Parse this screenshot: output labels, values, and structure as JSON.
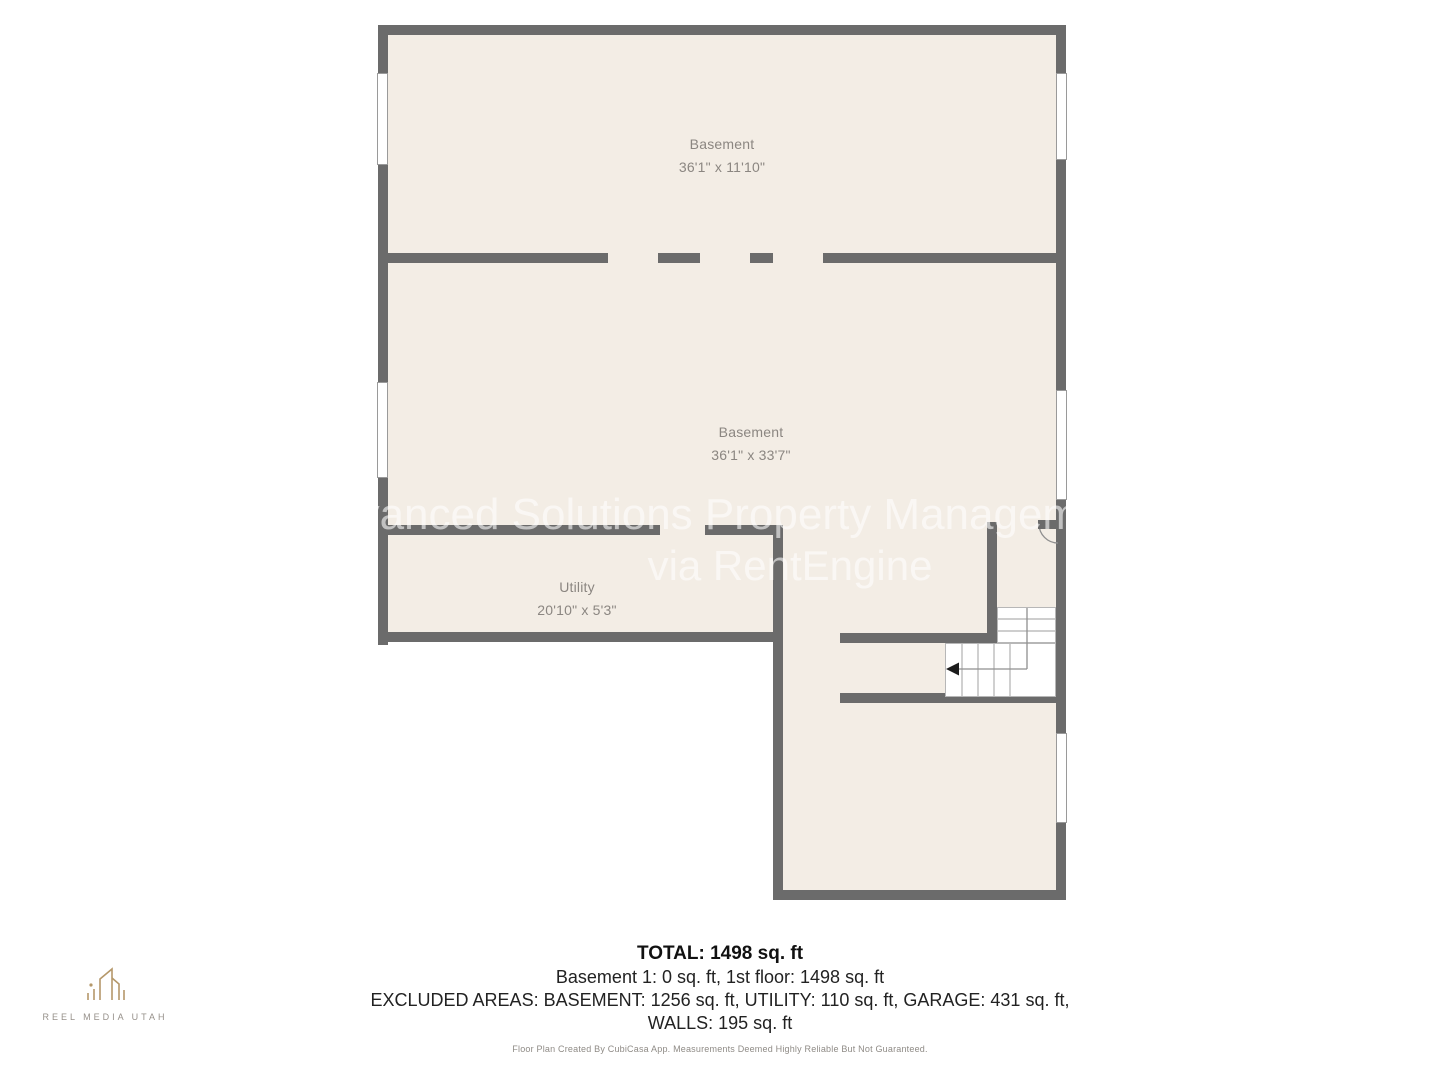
{
  "plan": {
    "rooms": [
      {
        "name": "Basement",
        "dims": "36'1\" x 11'10\""
      },
      {
        "name": "Basement",
        "dims": "36'1\" x 33'7\""
      },
      {
        "name": "Utility",
        "dims": "20'10\" x 5'3\""
      }
    ],
    "watermark": {
      "line1": "Advanced Solutions Property Management",
      "line2": "via RentEngine"
    }
  },
  "summary": {
    "total": "TOTAL: 1498 sq. ft",
    "floors": "Basement 1: 0 sq. ft, 1st floor: 1498 sq. ft",
    "excluded": "EXCLUDED AREAS: BASEMENT: 1256 sq. ft, UTILITY: 110 sq. ft, GARAGE: 431 sq. ft,",
    "walls": "WALLS: 195 sq. ft"
  },
  "footer": {
    "disclaimer": "Floor Plan Created By CubiCasa App. Measurements Deemed Highly Reliable But Not Guaranteed."
  },
  "branding": {
    "logo_text": "REEL MEDIA UTAH"
  },
  "colors": {
    "wall": "#6b6b6b",
    "floor": "#f3ede5",
    "accent_gold": "#b5986a"
  }
}
